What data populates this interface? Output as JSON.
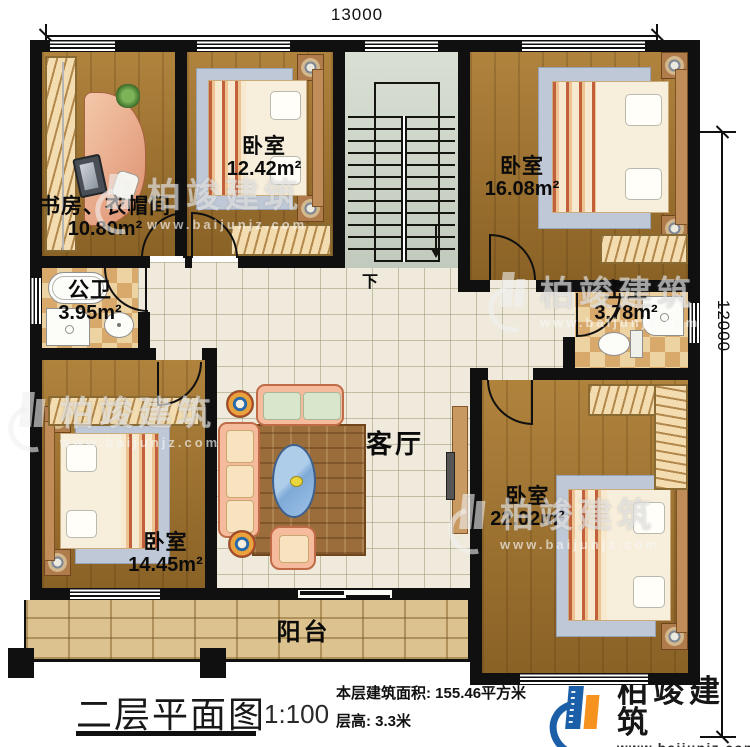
{
  "plan": {
    "title": "二层平面图",
    "scale": "1:100",
    "stats": {
      "area": "本层建筑面积: 155.46平方米",
      "floor_height": "层高: 3.3米"
    }
  },
  "dimensions": {
    "width": "13000",
    "height": "12000"
  },
  "rooms": {
    "study": {
      "name": "书房、衣帽间",
      "area": "10.80m²"
    },
    "bedroom_top_left": {
      "name": "卧室",
      "area": "12.42m²"
    },
    "bedroom_top_right": {
      "name": "卧室",
      "area": "16.08m²"
    },
    "public_bath": {
      "name": "公卫",
      "area": "3.95m²"
    },
    "master_bath": {
      "name": "主卫",
      "area": "3.78m²"
    },
    "living": {
      "name": "客厅"
    },
    "bedroom_bottom_left": {
      "name": "卧室",
      "area": "14.45m²"
    },
    "bedroom_bottom_right": {
      "name": "卧室",
      "area": "22.02m²"
    },
    "balcony": {
      "name": "阳台"
    }
  },
  "stairs": {
    "direction": "下"
  },
  "brand": {
    "name": "柏竣建筑",
    "website": "www.baijunjz.com"
  },
  "colors": {
    "wall": "#101010",
    "brand_blue": "#1a5fa8",
    "brand_orange": "#f6921e"
  }
}
